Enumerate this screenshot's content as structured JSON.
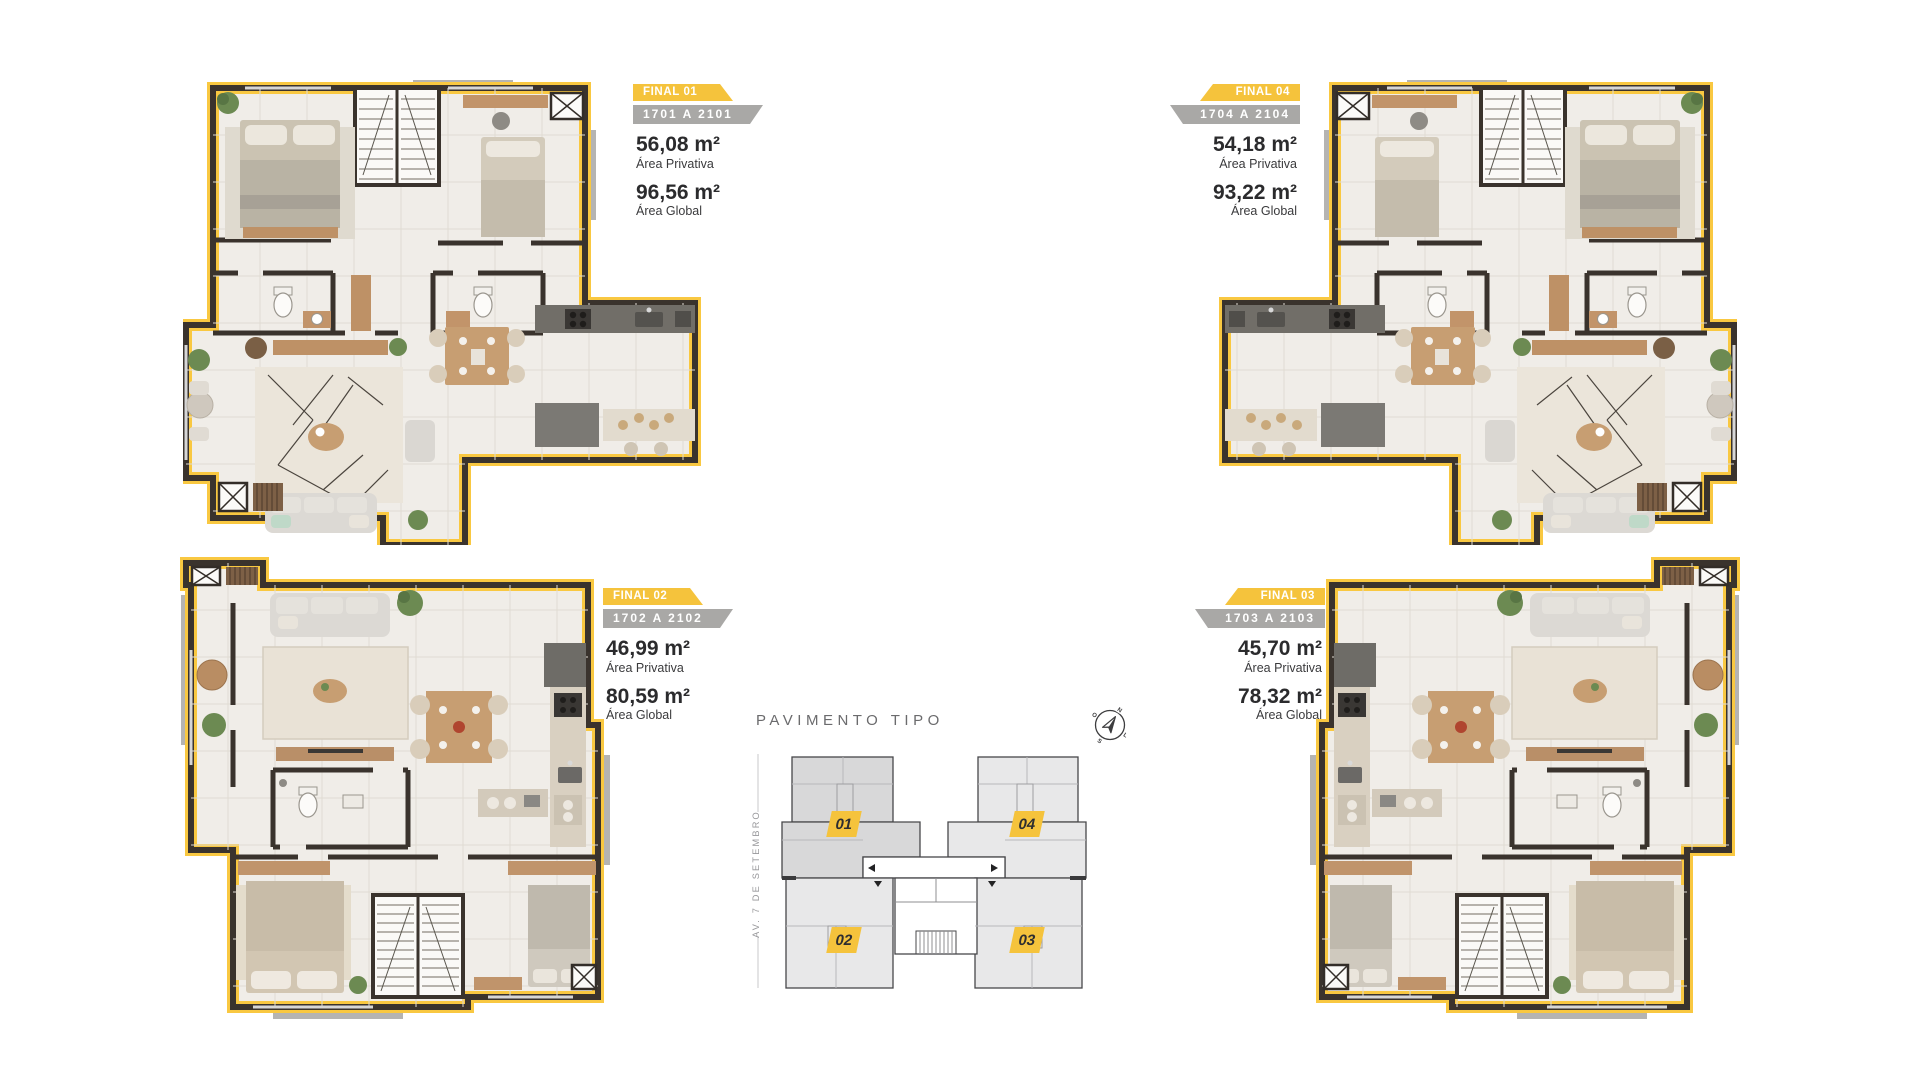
{
  "colors": {
    "accent_yellow": "#F5C33C",
    "plan_outline_yellow": "#F9C841",
    "banner_gray": "#A9A8A6",
    "wall_dark": "#3A332D",
    "floor_light": "#F0EDE8",
    "text_dark": "#2B2B2D",
    "keyplan_fill": "#E8E8E9",
    "keyplan_unit01_fill": "#D8D8D9"
  },
  "plans": [
    {
      "id": "final-01",
      "final_label": "FINAL 01",
      "range_label": "1701 A 2101",
      "private_value": "56,08 m²",
      "private_label": "Área Privativa",
      "global_value": "96,56 m²",
      "global_label": "Área Global"
    },
    {
      "id": "final-04",
      "final_label": "FINAL 04",
      "range_label": "1704 A 2104",
      "private_value": "54,18 m²",
      "private_label": "Área Privativa",
      "global_value": "93,22 m²",
      "global_label": "Área Global"
    },
    {
      "id": "final-02",
      "final_label": "FINAL 02",
      "range_label": "1702 A 2102",
      "private_value": "46,99 m²",
      "private_label": "Área Privativa",
      "global_value": "80,59 m²",
      "global_label": "Área Global"
    },
    {
      "id": "final-03",
      "final_label": "FINAL 03",
      "range_label": "1703 A 2103",
      "private_value": "45,70 m²",
      "private_label": "Área Privativa",
      "global_value": "78,32 m²",
      "global_label": "Área Global"
    }
  ],
  "key_plan": {
    "title": "PAVIMENTO TIPO",
    "street_label": "AV. 7 DE SETEMBRO",
    "units": [
      {
        "number": "01"
      },
      {
        "number": "04"
      },
      {
        "number": "02"
      },
      {
        "number": "03"
      }
    ],
    "compass": {
      "north": "N",
      "east": "L",
      "south": "S",
      "west": "O"
    }
  }
}
